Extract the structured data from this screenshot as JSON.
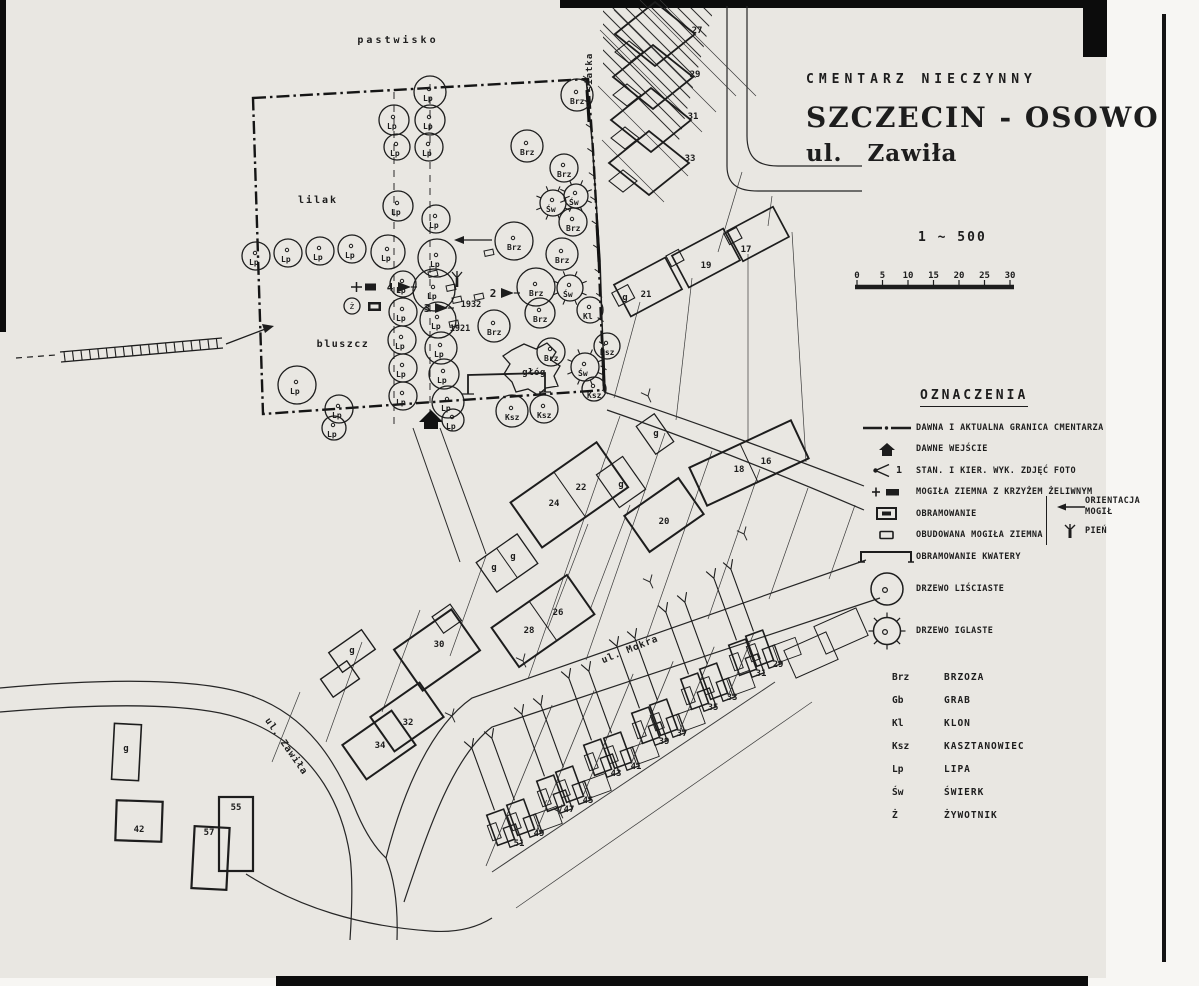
{
  "title": {
    "status": "CMENTARZ NIECZYNNY",
    "city": "SZCZECIN - OSOWO",
    "street": "ul. Zawiła"
  },
  "scale": {
    "ratio": "1 ~ 500",
    "ticks": [
      "0",
      "5",
      "10",
      "15",
      "20",
      "25",
      "30"
    ]
  },
  "legend": {
    "heading": "OZNACZENIA",
    "photo_sample": "1",
    "items": [
      {
        "symbol": "boundary-line",
        "label": "DAWNA I AKTUALNA GRANICA CMENTARZA"
      },
      {
        "symbol": "entrance-arrow",
        "label": "DAWNE WEJŚCIE"
      },
      {
        "symbol": "photo-station",
        "label": "STAN. I KIER. WYK. ZDJĘĆ FOTO"
      },
      {
        "symbol": "grave-cross",
        "label": "MOGIŁA ZIEMNA Z KRZYŻEM ŻELIWNYM"
      },
      {
        "symbol": "frame-filled",
        "label": "OBRAMOWANIE"
      },
      {
        "symbol": "built-grave",
        "label": "OBUDOWANA MOGIŁA ZIEMNA"
      },
      {
        "symbol": "quarter-frame",
        "label": "OBRAMOWANIE KWATERY"
      }
    ],
    "side_items": [
      {
        "symbol": "orientation-arrow",
        "label": "ORIENTACJA MOGIŁ"
      },
      {
        "symbol": "stump",
        "label": "PIEŃ"
      }
    ],
    "tree_items": [
      {
        "symbol": "tree-deciduous",
        "label": "DRZEWO LIŚCIASTE"
      },
      {
        "symbol": "tree-coniferous",
        "label": "DRZEWO IGLASTE"
      }
    ],
    "abbreviations": [
      {
        "abbr": "Brz",
        "name": "BRZOZA"
      },
      {
        "abbr": "Gb",
        "name": "GRAB"
      },
      {
        "abbr": "Kl",
        "name": "KLON"
      },
      {
        "abbr": "Ksz",
        "name": "KASZTANOWIEC"
      },
      {
        "abbr": "Lp",
        "name": "LIPA"
      },
      {
        "abbr": "Św",
        "name": "ŚWIERK"
      },
      {
        "abbr": "Ż",
        "name": "ŻYWOTNIK"
      }
    ]
  },
  "map": {
    "area_labels": [
      {
        "text": "pastwisko",
        "x": 398,
        "y": 43,
        "ls": 3,
        "size": 10
      },
      {
        "text": "lilak",
        "x": 318,
        "y": 203,
        "ls": 2,
        "size": 10
      },
      {
        "text": "bluszcz",
        "x": 343,
        "y": 347,
        "ls": 1.5,
        "size": 10
      },
      {
        "text": "głóg",
        "x": 534,
        "y": 375,
        "ls": 0.5,
        "size": 9
      },
      {
        "text": "siatka",
        "x": 592,
        "y": 72,
        "ls": 1,
        "size": 9,
        "rot": -90
      },
      {
        "text": "ul. Mokra",
        "x": 631,
        "y": 652,
        "ls": 1,
        "size": 9.5,
        "rot": -22
      },
      {
        "text": "ul. Zawiła",
        "x": 284,
        "y": 748,
        "ls": 1,
        "size": 9.5,
        "rot": 55
      }
    ],
    "dates": [
      {
        "text": "1932",
        "x": 471,
        "y": 307
      },
      {
        "text": "1921",
        "x": 460,
        "y": 331
      }
    ],
    "photo_stations": [
      {
        "n": "4",
        "x": 390,
        "y": 291
      },
      {
        "n": "3",
        "x": 427,
        "y": 312
      },
      {
        "n": "2",
        "x": 493,
        "y": 297
      }
    ],
    "trees": [
      {
        "x": 430,
        "y": 92,
        "r": 16,
        "s": "Lp",
        "t": "d"
      },
      {
        "x": 430,
        "y": 120,
        "r": 15,
        "s": "Lp",
        "t": "d"
      },
      {
        "x": 429,
        "y": 147,
        "r": 14,
        "s": "Lp",
        "t": "d"
      },
      {
        "x": 394,
        "y": 120,
        "r": 15,
        "s": "Lp",
        "t": "d"
      },
      {
        "x": 397,
        "y": 147,
        "r": 13,
        "s": "Lp",
        "t": "d"
      },
      {
        "x": 577,
        "y": 95,
        "r": 16,
        "s": "Brz",
        "t": "d"
      },
      {
        "x": 527,
        "y": 146,
        "r": 16,
        "s": "Brz",
        "t": "d"
      },
      {
        "x": 564,
        "y": 168,
        "r": 14,
        "s": "Brz",
        "t": "d"
      },
      {
        "x": 553,
        "y": 203,
        "r": 13,
        "s": "Św",
        "t": "i"
      },
      {
        "x": 576,
        "y": 196,
        "r": 12,
        "s": "Św",
        "t": "i"
      },
      {
        "x": 573,
        "y": 222,
        "r": 14,
        "s": "Brz",
        "t": "d"
      },
      {
        "x": 398,
        "y": 206,
        "r": 15,
        "s": "Lp",
        "t": "d"
      },
      {
        "x": 436,
        "y": 219,
        "r": 14,
        "s": "Lp",
        "t": "d"
      },
      {
        "x": 256,
        "y": 256,
        "r": 14,
        "s": "Lp",
        "t": "d"
      },
      {
        "x": 288,
        "y": 253,
        "r": 14,
        "s": "Lp",
        "t": "d"
      },
      {
        "x": 320,
        "y": 251,
        "r": 14,
        "s": "Lp",
        "t": "d"
      },
      {
        "x": 352,
        "y": 249,
        "r": 14,
        "s": "Lp",
        "t": "d"
      },
      {
        "x": 388,
        "y": 252,
        "r": 17,
        "s": "Lp",
        "t": "d"
      },
      {
        "x": 437,
        "y": 258,
        "r": 19,
        "s": "Lp",
        "t": "d"
      },
      {
        "x": 434,
        "y": 290,
        "r": 21,
        "s": "Lp",
        "t": "d"
      },
      {
        "x": 438,
        "y": 320,
        "r": 18,
        "s": "Lp",
        "t": "d"
      },
      {
        "x": 441,
        "y": 348,
        "r": 16,
        "s": "Lp",
        "t": "d"
      },
      {
        "x": 444,
        "y": 374,
        "r": 15,
        "s": "Lp",
        "t": "d"
      },
      {
        "x": 448,
        "y": 402,
        "r": 16,
        "s": "Lp",
        "t": "d"
      },
      {
        "x": 453,
        "y": 420,
        "r": 11,
        "s": "Lp",
        "t": "d"
      },
      {
        "x": 403,
        "y": 284,
        "r": 13,
        "s": "Lp",
        "t": "d"
      },
      {
        "x": 403,
        "y": 312,
        "r": 14,
        "s": "Lp",
        "t": "d"
      },
      {
        "x": 402,
        "y": 340,
        "r": 14,
        "s": "Lp",
        "t": "d"
      },
      {
        "x": 403,
        "y": 368,
        "r": 14,
        "s": "Lp",
        "t": "d"
      },
      {
        "x": 403,
        "y": 396,
        "r": 14,
        "s": "Lp",
        "t": "d"
      },
      {
        "x": 297,
        "y": 385,
        "r": 19,
        "s": "Lp",
        "t": "d"
      },
      {
        "x": 339,
        "y": 409,
        "r": 14,
        "s": "Lp",
        "t": "d"
      },
      {
        "x": 334,
        "y": 428,
        "r": 12,
        "s": "Lp",
        "t": "d"
      },
      {
        "x": 514,
        "y": 241,
        "r": 19,
        "s": "Brz",
        "t": "d"
      },
      {
        "x": 562,
        "y": 254,
        "r": 16,
        "s": "Brz",
        "t": "d"
      },
      {
        "x": 536,
        "y": 287,
        "r": 19,
        "s": "Brz",
        "t": "d"
      },
      {
        "x": 494,
        "y": 326,
        "r": 16,
        "s": "Brz",
        "t": "d"
      },
      {
        "x": 540,
        "y": 313,
        "r": 15,
        "s": "Brz",
        "t": "d"
      },
      {
        "x": 551,
        "y": 352,
        "r": 14,
        "s": "Brz",
        "t": "d"
      },
      {
        "x": 570,
        "y": 288,
        "r": 13,
        "s": "Św",
        "t": "i"
      },
      {
        "x": 590,
        "y": 310,
        "r": 13,
        "s": "Kl",
        "t": "d"
      },
      {
        "x": 607,
        "y": 346,
        "r": 13,
        "s": "Ksz",
        "t": "d"
      },
      {
        "x": 585,
        "y": 367,
        "r": 14,
        "s": "Św",
        "t": "i"
      },
      {
        "x": 594,
        "y": 389,
        "r": 12,
        "s": "Ksz",
        "t": "d"
      },
      {
        "x": 512,
        "y": 411,
        "r": 16,
        "s": "Ksz",
        "t": "d"
      },
      {
        "x": 544,
        "y": 409,
        "r": 14,
        "s": "Ksz",
        "t": "d"
      },
      {
        "x": 352,
        "y": 306,
        "r": 8,
        "s": "ż",
        "t": "z"
      }
    ],
    "house_numbers": [
      {
        "n": "27",
        "x": 697,
        "y": 30
      },
      {
        "n": "29",
        "x": 695,
        "y": 74
      },
      {
        "n": "31",
        "x": 693,
        "y": 116
      },
      {
        "n": "33",
        "x": 690,
        "y": 158
      },
      {
        "n": "17",
        "x": 746,
        "y": 249
      },
      {
        "n": "19",
        "x": 706,
        "y": 265
      },
      {
        "n": "21",
        "x": 646,
        "y": 294
      },
      {
        "n": "g",
        "x": 625,
        "y": 297
      },
      {
        "n": "16",
        "x": 766,
        "y": 461
      },
      {
        "n": "18",
        "x": 739,
        "y": 469
      },
      {
        "n": "22",
        "x": 581,
        "y": 487
      },
      {
        "n": "24",
        "x": 554,
        "y": 503
      },
      {
        "n": "20",
        "x": 664,
        "y": 521
      },
      {
        "n": "g",
        "x": 656,
        "y": 433
      },
      {
        "n": "g",
        "x": 621,
        "y": 484
      },
      {
        "n": "g",
        "x": 494,
        "y": 567
      },
      {
        "n": "g",
        "x": 513,
        "y": 556
      },
      {
        "n": "26",
        "x": 558,
        "y": 612
      },
      {
        "n": "28",
        "x": 529,
        "y": 630
      },
      {
        "n": "30",
        "x": 439,
        "y": 644
      },
      {
        "n": "g",
        "x": 352,
        "y": 650
      },
      {
        "n": "32",
        "x": 408,
        "y": 722
      },
      {
        "n": "34",
        "x": 380,
        "y": 745
      },
      {
        "n": "g",
        "x": 126,
        "y": 748
      },
      {
        "n": "42",
        "x": 139,
        "y": 829
      },
      {
        "n": "55",
        "x": 236,
        "y": 807
      },
      {
        "n": "57",
        "x": 209,
        "y": 832
      }
    ],
    "terrace_numbers": [
      {
        "n": "51",
        "x": 519,
        "y": 846
      },
      {
        "n": "49",
        "x": 539,
        "y": 836
      },
      {
        "n": "47",
        "x": 569,
        "y": 812
      },
      {
        "n": "45",
        "x": 588,
        "y": 803
      },
      {
        "n": "43",
        "x": 616,
        "y": 776
      },
      {
        "n": "41",
        "x": 636,
        "y": 769
      },
      {
        "n": "39",
        "x": 664,
        "y": 744
      },
      {
        "n": "37",
        "x": 682,
        "y": 736
      },
      {
        "n": "35",
        "x": 713,
        "y": 710
      },
      {
        "n": "33",
        "x": 732,
        "y": 700
      },
      {
        "n": "31",
        "x": 761,
        "y": 676
      },
      {
        "n": "29",
        "x": 778,
        "y": 667
      }
    ]
  }
}
